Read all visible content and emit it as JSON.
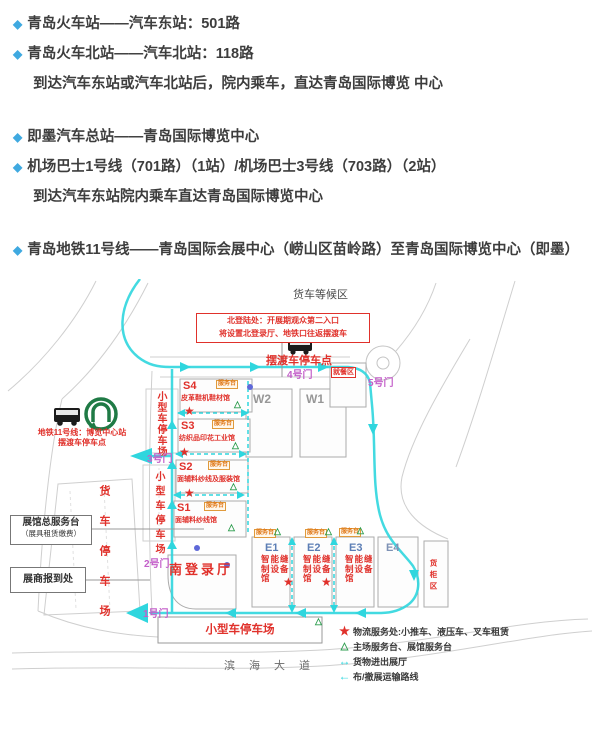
{
  "colors": {
    "bullet_blue": "#3fa9e0",
    "red": "#e0312b",
    "gate_purple": "#c35fc9",
    "route_cyan": "#2fd6de",
    "service_green": "#2e9e4f",
    "metro_green": "#1f7a45"
  },
  "transport": {
    "bullet_glyph": "◆",
    "items": [
      {
        "text": "青岛火车站——汽车东站：501路"
      },
      {
        "text": "青岛火车北站——汽车北站：118路"
      },
      {
        "text": "到达汽车东站或汽车北站后，院内乘车，直达青岛国际博览 中心"
      },
      {
        "text": "即墨汽车总站——青岛国际博览中心"
      },
      {
        "text": "机场巴士1号线（701路）（1站）/机场巴士3号线（703路）（2站）"
      },
      {
        "text": "到达汽车东站院内乘车直达青岛国际博览中心"
      },
      {
        "text": "青岛地铁11号线——青岛国际会展中心（崂山区苗岭路）至青岛国际博览中心（即墨）"
      }
    ]
  },
  "map": {
    "truck_wait_area": "货车等候区",
    "north_entry": {
      "line1": "北登陆处：开展期观众第二入口",
      "line2": "将设置北登录厅、地铁口往返摆渡车"
    },
    "shuttle_stop": "摆渡车停车点",
    "gates": {
      "g1": "1号门",
      "g2": "2号门",
      "g3": "3号门",
      "g4": "4号门",
      "g5": "5号门"
    },
    "dining_area": "就餐区",
    "metro_station": {
      "line1": "地铁11号线：博览中心站",
      "line2": "摆渡车停车点"
    },
    "parking": {
      "small_upper": "小型车停车场",
      "small_lower": "小型车停车场",
      "truck": "货车停车场",
      "small_box": "小型车停车场"
    },
    "service_desk_box": {
      "line1": "展馆总服务台",
      "line2": "（展具租赁缴费）"
    },
    "registration_box": "展商报到处",
    "south_hall": "南登录厅",
    "container_area": "货柜区",
    "road": "滨海大道",
    "halls": {
      "w": [
        {
          "id": "W2"
        },
        {
          "id": "W1"
        }
      ],
      "s": [
        {
          "id": "S4",
          "name": "皮革鞋机鞋材馆",
          "badge": "服务台"
        },
        {
          "id": "S3",
          "name": "纺织品印花工业馆",
          "badge": "服务台"
        },
        {
          "id": "S2",
          "name": "面辅料纱线及服装馆",
          "badge": "服务台"
        },
        {
          "id": "S1",
          "name": "面辅料纱线馆",
          "badge": "服务台"
        }
      ],
      "e": [
        {
          "id": "E1",
          "name": "智能缝制设备馆",
          "badge": "服务台"
        },
        {
          "id": "E2",
          "name": "智能缝制设备馆",
          "badge": "服务台"
        },
        {
          "id": "E3",
          "name": "智能缝制设备馆",
          "badge": "服务台"
        },
        {
          "id": "E4",
          "name": "",
          "badge": ""
        }
      ]
    },
    "legend": [
      {
        "symbol": "★",
        "text": "物流服务处:小推车、液压车、叉车租赁"
      },
      {
        "symbol": "△",
        "text": "主场服务台、展馆服务台"
      },
      {
        "symbol": "↔",
        "text": "货物进出展厅"
      },
      {
        "symbol": "←",
        "text": "布/撤展运输路线"
      }
    ]
  }
}
